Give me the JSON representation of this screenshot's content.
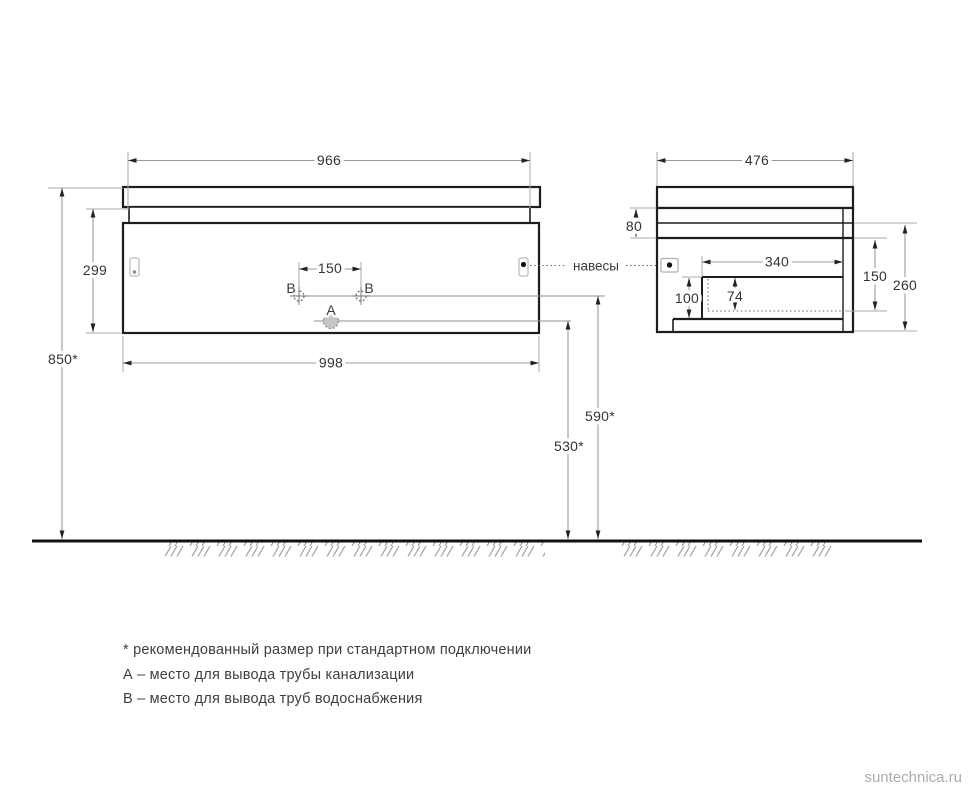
{
  "colors": {
    "background": "#ffffff",
    "outline": "#1d1d1d",
    "dimension_line": "#9a9a9a",
    "dimension_text": "#343434",
    "muted_bracket": "#b5b5b5",
    "watermark": "#ababab"
  },
  "front_view": {
    "top_width": "966",
    "bottom_width": "998",
    "body_height": "299",
    "mount_height": "850*",
    "supply_spacing": "150",
    "supply_line_height": "590*",
    "drain_line_height": "530*",
    "label_a": "A",
    "label_b": "B"
  },
  "side_view": {
    "depth": "476",
    "apron_height": "80",
    "cutout_width": "340",
    "back_cutout_height": "150",
    "body_height": "260",
    "front_cutout_height": "100",
    "recess_height": "74",
    "hangers_label": "навесы"
  },
  "notes": [
    "* рекомендованный размер при стандартном подключении",
    "А – место для вывода трубы канализации",
    "В – место для вывода труб водоснабжения"
  ],
  "watermark": "suntechnica.ru"
}
